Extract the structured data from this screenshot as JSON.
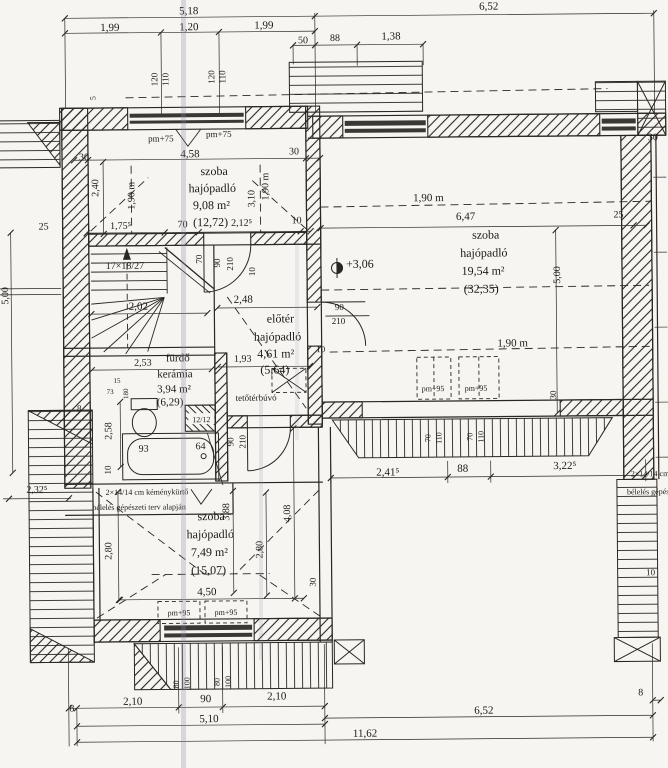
{
  "plan": {
    "kind": "floor-plan",
    "rooms": [
      {
        "id": "room-northwest",
        "name": "szoba",
        "flooring": "hajópadló",
        "area": "9,08 m²",
        "gross_area": "(12,72)"
      },
      {
        "id": "room-east",
        "name": "szoba",
        "flooring": "hajópadló",
        "area": "19,54 m²",
        "gross_area": "(32,35)"
      },
      {
        "id": "room-south",
        "name": "szoba",
        "flooring": "hajópadló",
        "area": "7,49 m²",
        "gross_area": "(15,07)"
      },
      {
        "id": "hall",
        "name": "előtér",
        "flooring": "hajópadló",
        "area": "4,61 m²",
        "gross_area": "(5,64)"
      },
      {
        "id": "bathroom",
        "name": "fürdő",
        "flooring": "kerámia",
        "area": "3,94 m²",
        "gross_area": "(6,29)"
      }
    ],
    "annotations": {
      "stair_formula": "17×18/27",
      "level_mark": "+3,06",
      "attic_hatch": "tetőtérbúvó",
      "chimney_note_1": "2×14/14 cm kéménykürtő",
      "chimney_note_2": "bélelés gépészeti terv alapján",
      "chimney_block": "12/12"
    },
    "labels": [
      {
        "n": "dim-518",
        "t": "5,18",
        "x": 192,
        "y": 13
      },
      {
        "n": "dim-199a",
        "t": "1,99",
        "x": 113,
        "y": 29
      },
      {
        "n": "dim-120",
        "t": "1,20",
        "x": 192,
        "y": 29
      },
      {
        "n": "dim-199b",
        "t": "1,99",
        "x": 267,
        "y": 28
      },
      {
        "n": "dim-652-top",
        "t": "6,52",
        "x": 492,
        "y": 11
      },
      {
        "n": "dim-50",
        "t": "50",
        "x": 306,
        "y": 43,
        "s": 10
      },
      {
        "n": "dim-88-top",
        "t": "88",
        "x": 338,
        "y": 41,
        "s": 10
      },
      {
        "n": "dim-138",
        "t": "1,38",
        "x": 394,
        "y": 40
      },
      {
        "n": "win-120a",
        "t": "120",
        "x": 160,
        "y": 78,
        "r": -90,
        "s": 9
      },
      {
        "n": "win-110a",
        "t": "110",
        "x": 171,
        "y": 78,
        "r": -90,
        "s": 9
      },
      {
        "n": "win-120b",
        "t": "120",
        "x": 217,
        "y": 76,
        "r": -90,
        "s": 9
      },
      {
        "n": "win-110b",
        "t": "110",
        "x": 228,
        "y": 76,
        "r": -90,
        "s": 9
      },
      {
        "n": "mark-5",
        "t": "5",
        "x": 98,
        "y": 96,
        "r": -90,
        "s": 8
      },
      {
        "n": "pm75-a",
        "t": "pm+75",
        "x": 163,
        "y": 140,
        "s": 9
      },
      {
        "n": "pm75-b",
        "t": "pm+75",
        "x": 221,
        "y": 136,
        "s": 9
      },
      {
        "n": "dim-30a",
        "t": "30",
        "x": 86,
        "y": 158,
        "s": 10
      },
      {
        "n": "dim-458",
        "t": "4,58",
        "x": 192,
        "y": 156
      },
      {
        "n": "dim-30b",
        "t": "30",
        "x": 296,
        "y": 154,
        "s": 10
      },
      {
        "n": "dim-240",
        "t": "2,40",
        "x": 100,
        "y": 186,
        "r": -90,
        "s": 10
      },
      {
        "n": "dim-190-nw-left",
        "t": "1,90 m",
        "x": 136,
        "y": 194,
        "r": -90,
        "s": 10
      },
      {
        "n": "room-nw-name",
        "t": "szoba",
        "x": 216,
        "y": 174,
        "s": 12
      },
      {
        "n": "room-nw-floor",
        "t": "hajópadló",
        "x": 214,
        "y": 191,
        "s": 12
      },
      {
        "n": "room-nw-area",
        "t": "9,08 m²",
        "x": 213,
        "y": 208,
        "s": 12
      },
      {
        "n": "room-nw-gross",
        "t": "(12,72)",
        "x": 212,
        "y": 225,
        "s": 12
      },
      {
        "n": "dim-310",
        "t": "3,10",
        "x": 256,
        "y": 198,
        "r": -90,
        "s": 10
      },
      {
        "n": "dim-190-nw-right",
        "t": "1,90 m",
        "x": 270,
        "y": 186,
        "r": -90,
        "s": 10
      },
      {
        "n": "dim-25-left",
        "t": "25",
        "x": 45,
        "y": 227,
        "s": 10
      },
      {
        "n": "dim-1755",
        "t": "1,75⁵",
        "x": 122,
        "y": 227,
        "s": 10
      },
      {
        "n": "dim-70",
        "t": "70",
        "x": 184,
        "y": 226,
        "s": 10
      },
      {
        "n": "dim-2125",
        "t": "2,12⁵",
        "x": 243,
        "y": 225,
        "s": 10
      },
      {
        "n": "dim-10a",
        "t": "10",
        "x": 298,
        "y": 223,
        "s": 10
      },
      {
        "n": "stair-formula",
        "t": "17×18/27",
        "x": 126,
        "y": 267,
        "s": 10
      },
      {
        "n": "dim-202",
        "t": "2,02",
        "x": 139,
        "y": 308
      },
      {
        "n": "door-nw-70",
        "t": "70",
        "x": 203,
        "y": 258,
        "r": -90,
        "s": 9
      },
      {
        "n": "door-nw-90",
        "t": "90",
        "x": 221,
        "y": 262,
        "r": -90,
        "s": 9
      },
      {
        "n": "door-nw-210",
        "t": "210",
        "x": 234,
        "y": 263,
        "r": -90,
        "s": 9
      },
      {
        "n": "door-nw-10",
        "t": "10",
        "x": 256,
        "y": 271,
        "r": -90,
        "s": 9
      },
      {
        "n": "dim-248",
        "t": "2,48",
        "x": 244,
        "y": 302
      },
      {
        "n": "room-hall-name",
        "t": "előtér",
        "x": 281,
        "y": 322,
        "s": 12
      },
      {
        "n": "room-hall-floor",
        "t": "hajópadló",
        "x": 278,
        "y": 340,
        "s": 12
      },
      {
        "n": "room-hall-area",
        "t": "4,61 m²",
        "x": 276,
        "y": 357,
        "s": 12
      },
      {
        "n": "dim-193",
        "t": "1,93",
        "x": 243,
        "y": 361,
        "s": 10
      },
      {
        "n": "room-hall-gross",
        "t": "(5,64)",
        "x": 275,
        "y": 373,
        "s": 12
      },
      {
        "n": "attic-hatch-label",
        "t": "tetőtérbúvó",
        "x": 256,
        "y": 400,
        "s": 9
      },
      {
        "n": "dim-10b",
        "t": "10",
        "x": 321,
        "y": 352,
        "s": 9
      },
      {
        "n": "door-e-90",
        "t": "90",
        "x": 340,
        "y": 310,
        "s": 9
      },
      {
        "n": "door-e-210",
        "t": "210",
        "x": 339,
        "y": 324,
        "s": 9
      },
      {
        "n": "level-306",
        "t": "+3,06",
        "x": 347,
        "y": 268,
        "s": 12,
        "a": "start"
      },
      {
        "n": "dim-190-e1",
        "t": "1,90 m",
        "x": 430,
        "y": 202
      },
      {
        "n": "dim-647",
        "t": "6,47",
        "x": 467,
        "y": 221
      },
      {
        "n": "dim-25-e",
        "t": "25",
        "x": 620,
        "y": 220,
        "s": 10
      },
      {
        "n": "room-e-name",
        "t": "szoba",
        "x": 487,
        "y": 240,
        "s": 12
      },
      {
        "n": "room-e-floor",
        "t": "hajópadló",
        "x": 485,
        "y": 258,
        "s": 12
      },
      {
        "n": "room-e-area",
        "t": "19,54 m²",
        "x": 484,
        "y": 276,
        "s": 12
      },
      {
        "n": "room-e-gross",
        "t": "(32,35)",
        "x": 482,
        "y": 294,
        "s": 12
      },
      {
        "n": "dim-500-e",
        "t": "5,00",
        "x": 561,
        "y": 277,
        "r": -90,
        "s": 10
      },
      {
        "n": "dim-190-e2",
        "t": "1,90 m",
        "x": 513,
        "y": 348
      },
      {
        "n": "pm95-a",
        "t": "pm+95",
        "x": 433,
        "y": 392,
        "s": 8
      },
      {
        "n": "pm95-b",
        "t": "pm+95",
        "x": 476,
        "y": 392,
        "s": 8
      },
      {
        "n": "dim-30-e",
        "t": "30",
        "x": 556,
        "y": 397,
        "r": -90,
        "s": 9
      },
      {
        "n": "dim-30-ne",
        "t": "30",
        "x": 655,
        "y": 143,
        "s": 10
      },
      {
        "n": "dim-2415",
        "t": "2,41⁵",
        "x": 387,
        "y": 476
      },
      {
        "n": "dim-88-e",
        "t": "88",
        "x": 462,
        "y": 473
      },
      {
        "n": "dim-3225",
        "t": "3,22⁵",
        "x": 564,
        "y": 471
      },
      {
        "n": "roofwin-70a",
        "t": "70",
        "x": 430,
        "y": 439,
        "r": -90,
        "s": 8
      },
      {
        "n": "roofwin-110a",
        "t": "110",
        "x": 441,
        "y": 439,
        "r": -90,
        "s": 8
      },
      {
        "n": "roofwin-70b",
        "t": "70",
        "x": 472,
        "y": 438,
        "r": -90,
        "s": 8
      },
      {
        "n": "roofwin-110b",
        "t": "110",
        "x": 483,
        "y": 438,
        "r": -90,
        "s": 8
      },
      {
        "n": "door-s-90",
        "t": "90",
        "x": 233,
        "y": 441,
        "r": -90,
        "s": 9
      },
      {
        "n": "door-s-210",
        "t": "210",
        "x": 245,
        "y": 441,
        "r": -90,
        "s": 9
      },
      {
        "n": "room-bath-name",
        "t": "fürdő",
        "x": 178,
        "y": 360,
        "s": 11
      },
      {
        "n": "room-bath-floor",
        "t": "kerámia",
        "x": 175,
        "y": 376,
        "s": 11
      },
      {
        "n": "room-bath-area",
        "t": "3,94 m²",
        "x": 174,
        "y": 391,
        "s": 11
      },
      {
        "n": "room-bath-gross",
        "t": "(6,29)",
        "x": 170,
        "y": 404,
        "s": 11
      },
      {
        "n": "dim-253",
        "t": "2,53",
        "x": 143,
        "y": 364,
        "s": 10
      },
      {
        "n": "dim-258",
        "t": "2,58",
        "x": 111,
        "y": 429,
        "r": -90,
        "s": 10
      },
      {
        "n": "dim-93",
        "t": "93",
        "x": 143,
        "y": 450,
        "s": 10
      },
      {
        "n": "dim-64",
        "t": "64",
        "x": 200,
        "y": 448,
        "s": 10
      },
      {
        "n": "dim-10c",
        "t": "10",
        "x": 110,
        "y": 468,
        "r": -90,
        "s": 9
      },
      {
        "n": "dim-15",
        "t": "15",
        "x": 117,
        "y": 381,
        "s": 7
      },
      {
        "n": "dim-73",
        "t": "73",
        "x": 110,
        "y": 392,
        "s": 7
      },
      {
        "n": "dim-180",
        "t": "180",
        "x": 128,
        "y": 392,
        "r": -90,
        "s": 7
      },
      {
        "n": "chimney-size",
        "t": "12/12",
        "x": 201,
        "y": 421,
        "s": 8
      },
      {
        "n": "note-chimney-1",
        "t": "2×14/14 cm kéménykürtő",
        "x": 146,
        "y": 493,
        "s": 8
      },
      {
        "n": "note-chimney-2",
        "t": "bélelés gépészeti terv alapján",
        "x": 138,
        "y": 508,
        "s": 8
      },
      {
        "n": "dim-2325",
        "t": "2,32⁵",
        "x": 36,
        "y": 490,
        "s": 10
      },
      {
        "n": "dim-8-left",
        "t": "8",
        "x": 79,
        "y": 409,
        "s": 9
      },
      {
        "n": "dim-280-l",
        "t": "2,80",
        "x": 110,
        "y": 549,
        "r": -90,
        "s": 10
      },
      {
        "n": "room-s-name",
        "t": "szoba",
        "x": 210,
        "y": 519,
        "s": 12
      },
      {
        "n": "room-s-floor",
        "t": "hajópadló",
        "x": 209,
        "y": 537,
        "s": 12
      },
      {
        "n": "room-s-area",
        "t": "7,49 m²",
        "x": 208,
        "y": 555,
        "s": 12
      },
      {
        "n": "room-s-gross",
        "t": "(15,07)",
        "x": 207,
        "y": 573,
        "s": 12
      },
      {
        "n": "dim-388",
        "t": "3,88",
        "x": 228,
        "y": 511,
        "r": -90,
        "s": 10
      },
      {
        "n": "dim-408",
        "t": "4,08",
        "x": 289,
        "y": 513,
        "r": -90,
        "s": 10
      },
      {
        "n": "dim-280-r",
        "t": "2,80",
        "x": 261,
        "y": 549,
        "r": -90,
        "s": 10
      },
      {
        "n": "dim-450",
        "t": "4,50",
        "x": 205,
        "y": 594
      },
      {
        "n": "pm95-c",
        "t": "pm+95",
        "x": 177,
        "y": 614,
        "s": 8
      },
      {
        "n": "pm95-d",
        "t": "pm+95",
        "x": 224,
        "y": 614,
        "s": 8
      },
      {
        "n": "dim-30-s",
        "t": "30",
        "x": 314,
        "y": 582,
        "r": -90,
        "s": 9
      },
      {
        "n": "win-80a",
        "t": "80",
        "x": 176,
        "y": 683,
        "r": -90,
        "s": 8
      },
      {
        "n": "win-100a",
        "t": "100",
        "x": 187,
        "y": 682,
        "r": -90,
        "s": 8
      },
      {
        "n": "win-80b",
        "t": "80",
        "x": 217,
        "y": 681,
        "r": -90,
        "s": 8
      },
      {
        "n": "win-100b",
        "t": "100",
        "x": 228,
        "y": 681,
        "r": -90,
        "s": 8
      },
      {
        "n": "dim-8-bl",
        "t": "8",
        "x": 69,
        "y": 709,
        "s": 10
      },
      {
        "n": "dim-210a",
        "t": "2,10",
        "x": 130,
        "y": 703
      },
      {
        "n": "dim-90-b",
        "t": "90",
        "x": 203,
        "y": 701
      },
      {
        "n": "dim-210b",
        "t": "2,10",
        "x": 274,
        "y": 699
      },
      {
        "n": "dim-510",
        "t": "5,10",
        "x": 206,
        "y": 721
      },
      {
        "n": "dim-652-b",
        "t": "6,52",
        "x": 481,
        "y": 715
      },
      {
        "n": "dim-1162",
        "t": "11,62",
        "x": 362,
        "y": 737
      },
      {
        "n": "dim-8-br",
        "t": "8",
        "x": 638,
        "y": 698,
        "s": 10
      },
      {
        "n": "dim-500-w",
        "t": "5,00",
        "x": 9,
        "y": 293,
        "r": -90,
        "s": 10
      },
      {
        "n": "dim-10-se",
        "t": "10",
        "x": 649,
        "y": 578,
        "s": 9
      },
      {
        "n": "note-right-1",
        "t": "2×14/14 cm kéménykürtő",
        "x": 630,
        "y": 479,
        "s": 8,
        "a": "start"
      },
      {
        "n": "note-right-2",
        "t": "bélelés gépészeti terv alapján",
        "x": 626,
        "y": 497,
        "s": 8,
        "a": "start"
      }
    ],
    "colors": {
      "paper": "#f6f5f1",
      "ink": "#2a2723",
      "fold": "#8d84a3"
    }
  }
}
